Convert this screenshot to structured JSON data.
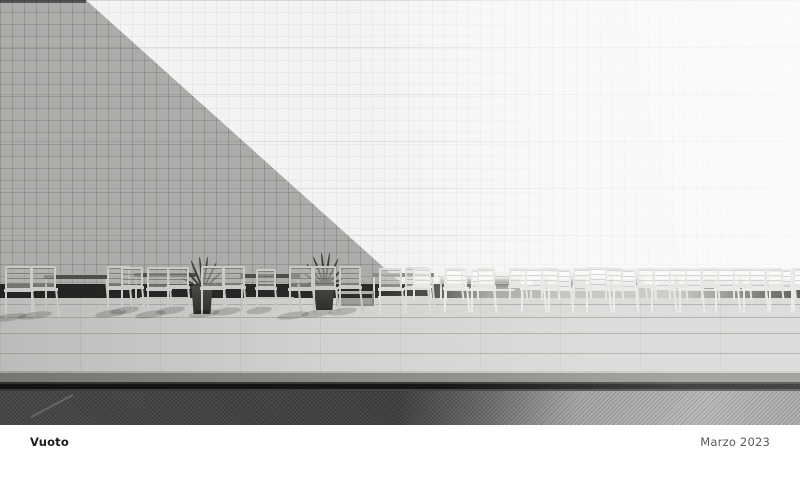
{
  "footer": {
    "title": "Vuoto",
    "date": "Marzo 2023"
  },
  "photo": {
    "palette": {
      "pageBg": "#ffffff",
      "wallLit": "#f5f5f3",
      "wallShadow": "rgba(30,30,28,0.335)",
      "skirtDark": "#242422",
      "skirtLight": "#c6c6c2",
      "floor": "#d8d7d5",
      "step": "#90908c",
      "gapDark": "#161614",
      "waterDark": "#474745",
      "waterLight": "#bcbcba",
      "tableDarkTop": "#504f4b",
      "leaf": "#3c3c38",
      "captionTitle": "#1c1c1c",
      "captionDate": "#5a5a5a"
    },
    "scene": {
      "floor_lines_y": [
        6,
        19,
        35,
        55
      ],
      "tables": [
        {
          "x": 44,
          "b": 315,
          "w": 64,
          "h": 40,
          "k": "s"
        },
        {
          "x": 134,
          "b": 313,
          "w": 62,
          "h": 40,
          "k": "s"
        },
        {
          "x": 240,
          "b": 312,
          "w": 60,
          "h": 38,
          "k": "s"
        },
        {
          "x": 372,
          "b": 311,
          "w": 62,
          "h": 38,
          "k": "d"
        },
        {
          "x": 438,
          "b": 300,
          "w": 86,
          "h": 28,
          "k": "l"
        },
        {
          "x": 528,
          "b": 300,
          "w": 120,
          "h": 28,
          "k": "l"
        },
        {
          "x": 652,
          "b": 300,
          "w": 146,
          "h": 28,
          "k": "l"
        }
      ],
      "benches": [
        {
          "x": 336,
          "b": 306,
          "w": 38,
          "h": 15
        }
      ],
      "plants": [
        {
          "x": 172,
          "b": 314,
          "w": 60,
          "h": 64
        },
        {
          "x": 296,
          "b": 310,
          "w": 56,
          "h": 58
        }
      ],
      "chairs": [
        {
          "x": 4,
          "b": 318,
          "w": 30,
          "h": 52,
          "k": "s"
        },
        {
          "x": 30,
          "b": 316,
          "w": 28,
          "h": 50,
          "k": "s"
        },
        {
          "x": 106,
          "b": 314,
          "w": 26,
          "h": 48,
          "k": "s"
        },
        {
          "x": 120,
          "b": 311,
          "w": 24,
          "h": 44,
          "k": "s"
        },
        {
          "x": 146,
          "b": 315,
          "w": 26,
          "h": 48,
          "k": "s"
        },
        {
          "x": 166,
          "b": 311,
          "w": 24,
          "h": 44,
          "k": "s"
        },
        {
          "x": 200,
          "b": 314,
          "w": 26,
          "h": 48,
          "k": "s"
        },
        {
          "x": 222,
          "b": 312,
          "w": 24,
          "h": 46,
          "k": "s"
        },
        {
          "x": 255,
          "b": 311,
          "w": 22,
          "h": 42,
          "k": "s"
        },
        {
          "x": 288,
          "b": 316,
          "w": 27,
          "h": 50,
          "k": "s"
        },
        {
          "x": 312,
          "b": 314,
          "w": 26,
          "h": 48,
          "k": "s"
        },
        {
          "x": 338,
          "b": 312,
          "w": 24,
          "h": 46,
          "k": "s"
        },
        {
          "x": 378,
          "b": 314,
          "w": 26,
          "h": 46,
          "k": "d"
        },
        {
          "x": 404,
          "b": 313,
          "w": 26,
          "h": 46,
          "k": "d"
        },
        {
          "x": 443,
          "b": 312,
          "w": 26,
          "h": 44,
          "k": "l"
        },
        {
          "x": 470,
          "b": 313,
          "w": 26,
          "h": 44,
          "k": "l"
        },
        {
          "x": 520,
          "b": 312,
          "w": 26,
          "h": 44,
          "k": "l"
        },
        {
          "x": 547,
          "b": 313,
          "w": 26,
          "h": 44,
          "k": "l"
        },
        {
          "x": 585,
          "b": 312,
          "w": 26,
          "h": 45,
          "k": "l"
        },
        {
          "x": 612,
          "b": 313,
          "w": 26,
          "h": 44,
          "k": "l"
        },
        {
          "x": 650,
          "b": 312,
          "w": 26,
          "h": 44,
          "k": "l"
        },
        {
          "x": 678,
          "b": 312,
          "w": 26,
          "h": 44,
          "k": "l"
        },
        {
          "x": 714,
          "b": 313,
          "w": 26,
          "h": 45,
          "k": "l"
        },
        {
          "x": 742,
          "b": 312,
          "w": 26,
          "h": 44,
          "k": "l"
        },
        {
          "x": 768,
          "b": 313,
          "w": 26,
          "h": 44,
          "k": "l"
        },
        {
          "x": 790,
          "b": 312,
          "w": 24,
          "h": 44,
          "k": "l"
        },
        {
          "x": 412,
          "b": 300,
          "w": 20,
          "h": 32,
          "k": "m"
        },
        {
          "x": 444,
          "b": 300,
          "w": 20,
          "h": 32,
          "k": "m"
        },
        {
          "x": 476,
          "b": 300,
          "w": 20,
          "h": 32,
          "k": "m"
        },
        {
          "x": 508,
          "b": 300,
          "w": 20,
          "h": 32,
          "k": "m"
        },
        {
          "x": 540,
          "b": 300,
          "w": 20,
          "h": 32,
          "k": "m"
        },
        {
          "x": 572,
          "b": 300,
          "w": 20,
          "h": 32,
          "k": "m"
        },
        {
          "x": 604,
          "b": 300,
          "w": 20,
          "h": 32,
          "k": "m"
        },
        {
          "x": 636,
          "b": 300,
          "w": 20,
          "h": 32,
          "k": "m"
        },
        {
          "x": 668,
          "b": 300,
          "w": 20,
          "h": 32,
          "k": "m"
        },
        {
          "x": 700,
          "b": 300,
          "w": 20,
          "h": 32,
          "k": "m"
        },
        {
          "x": 732,
          "b": 300,
          "w": 20,
          "h": 32,
          "k": "m"
        },
        {
          "x": 764,
          "b": 300,
          "w": 20,
          "h": 32,
          "k": "m"
        },
        {
          "x": 792,
          "b": 300,
          "w": 20,
          "h": 32,
          "k": "m"
        }
      ]
    }
  }
}
